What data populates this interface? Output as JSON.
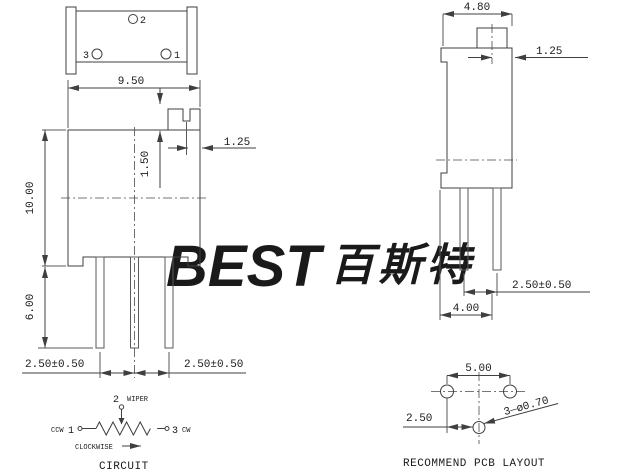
{
  "colors": {
    "watermark": "#d9e8f5",
    "line": "#3f3f3f",
    "text": "#1a1a1a"
  },
  "watermark": {
    "logo": "BEST",
    "cjk": "百斯特"
  },
  "top_view": {
    "hole_2_label": "2",
    "hole_3_label": "3",
    "hole_1_label": "1"
  },
  "front_view": {
    "width_dim": "9.50",
    "height_dim": "10.00",
    "pin_length_dim": "6.00",
    "screw_slot_depth_dim": "1.50",
    "screw_slot_offset_dim": "1.25",
    "pin_pitch_left_dim": "2.50±0.50",
    "pin_pitch_right_dim": "2.50±0.50"
  },
  "side_view": {
    "width_dim": "4.80",
    "screw_offset_dim": "1.25",
    "pin_pitch_dim": "2.50±0.50",
    "depth_dim": "4.00"
  },
  "circuit": {
    "terminal_2": "2",
    "wiper_label": "WIPER",
    "ccw_label": "CCW",
    "terminal_1": "1",
    "terminal_3": "3",
    "cw_label": "CW",
    "clockwise_label": "CLOCKWISE",
    "caption": "CIRCUIT"
  },
  "pcb_layout": {
    "pad_span_dim": "5.00",
    "pad_offset_dim": "2.50",
    "hole_spec": "3—ø0.70",
    "caption": "RECOMMEND PCB LAYOUT"
  }
}
